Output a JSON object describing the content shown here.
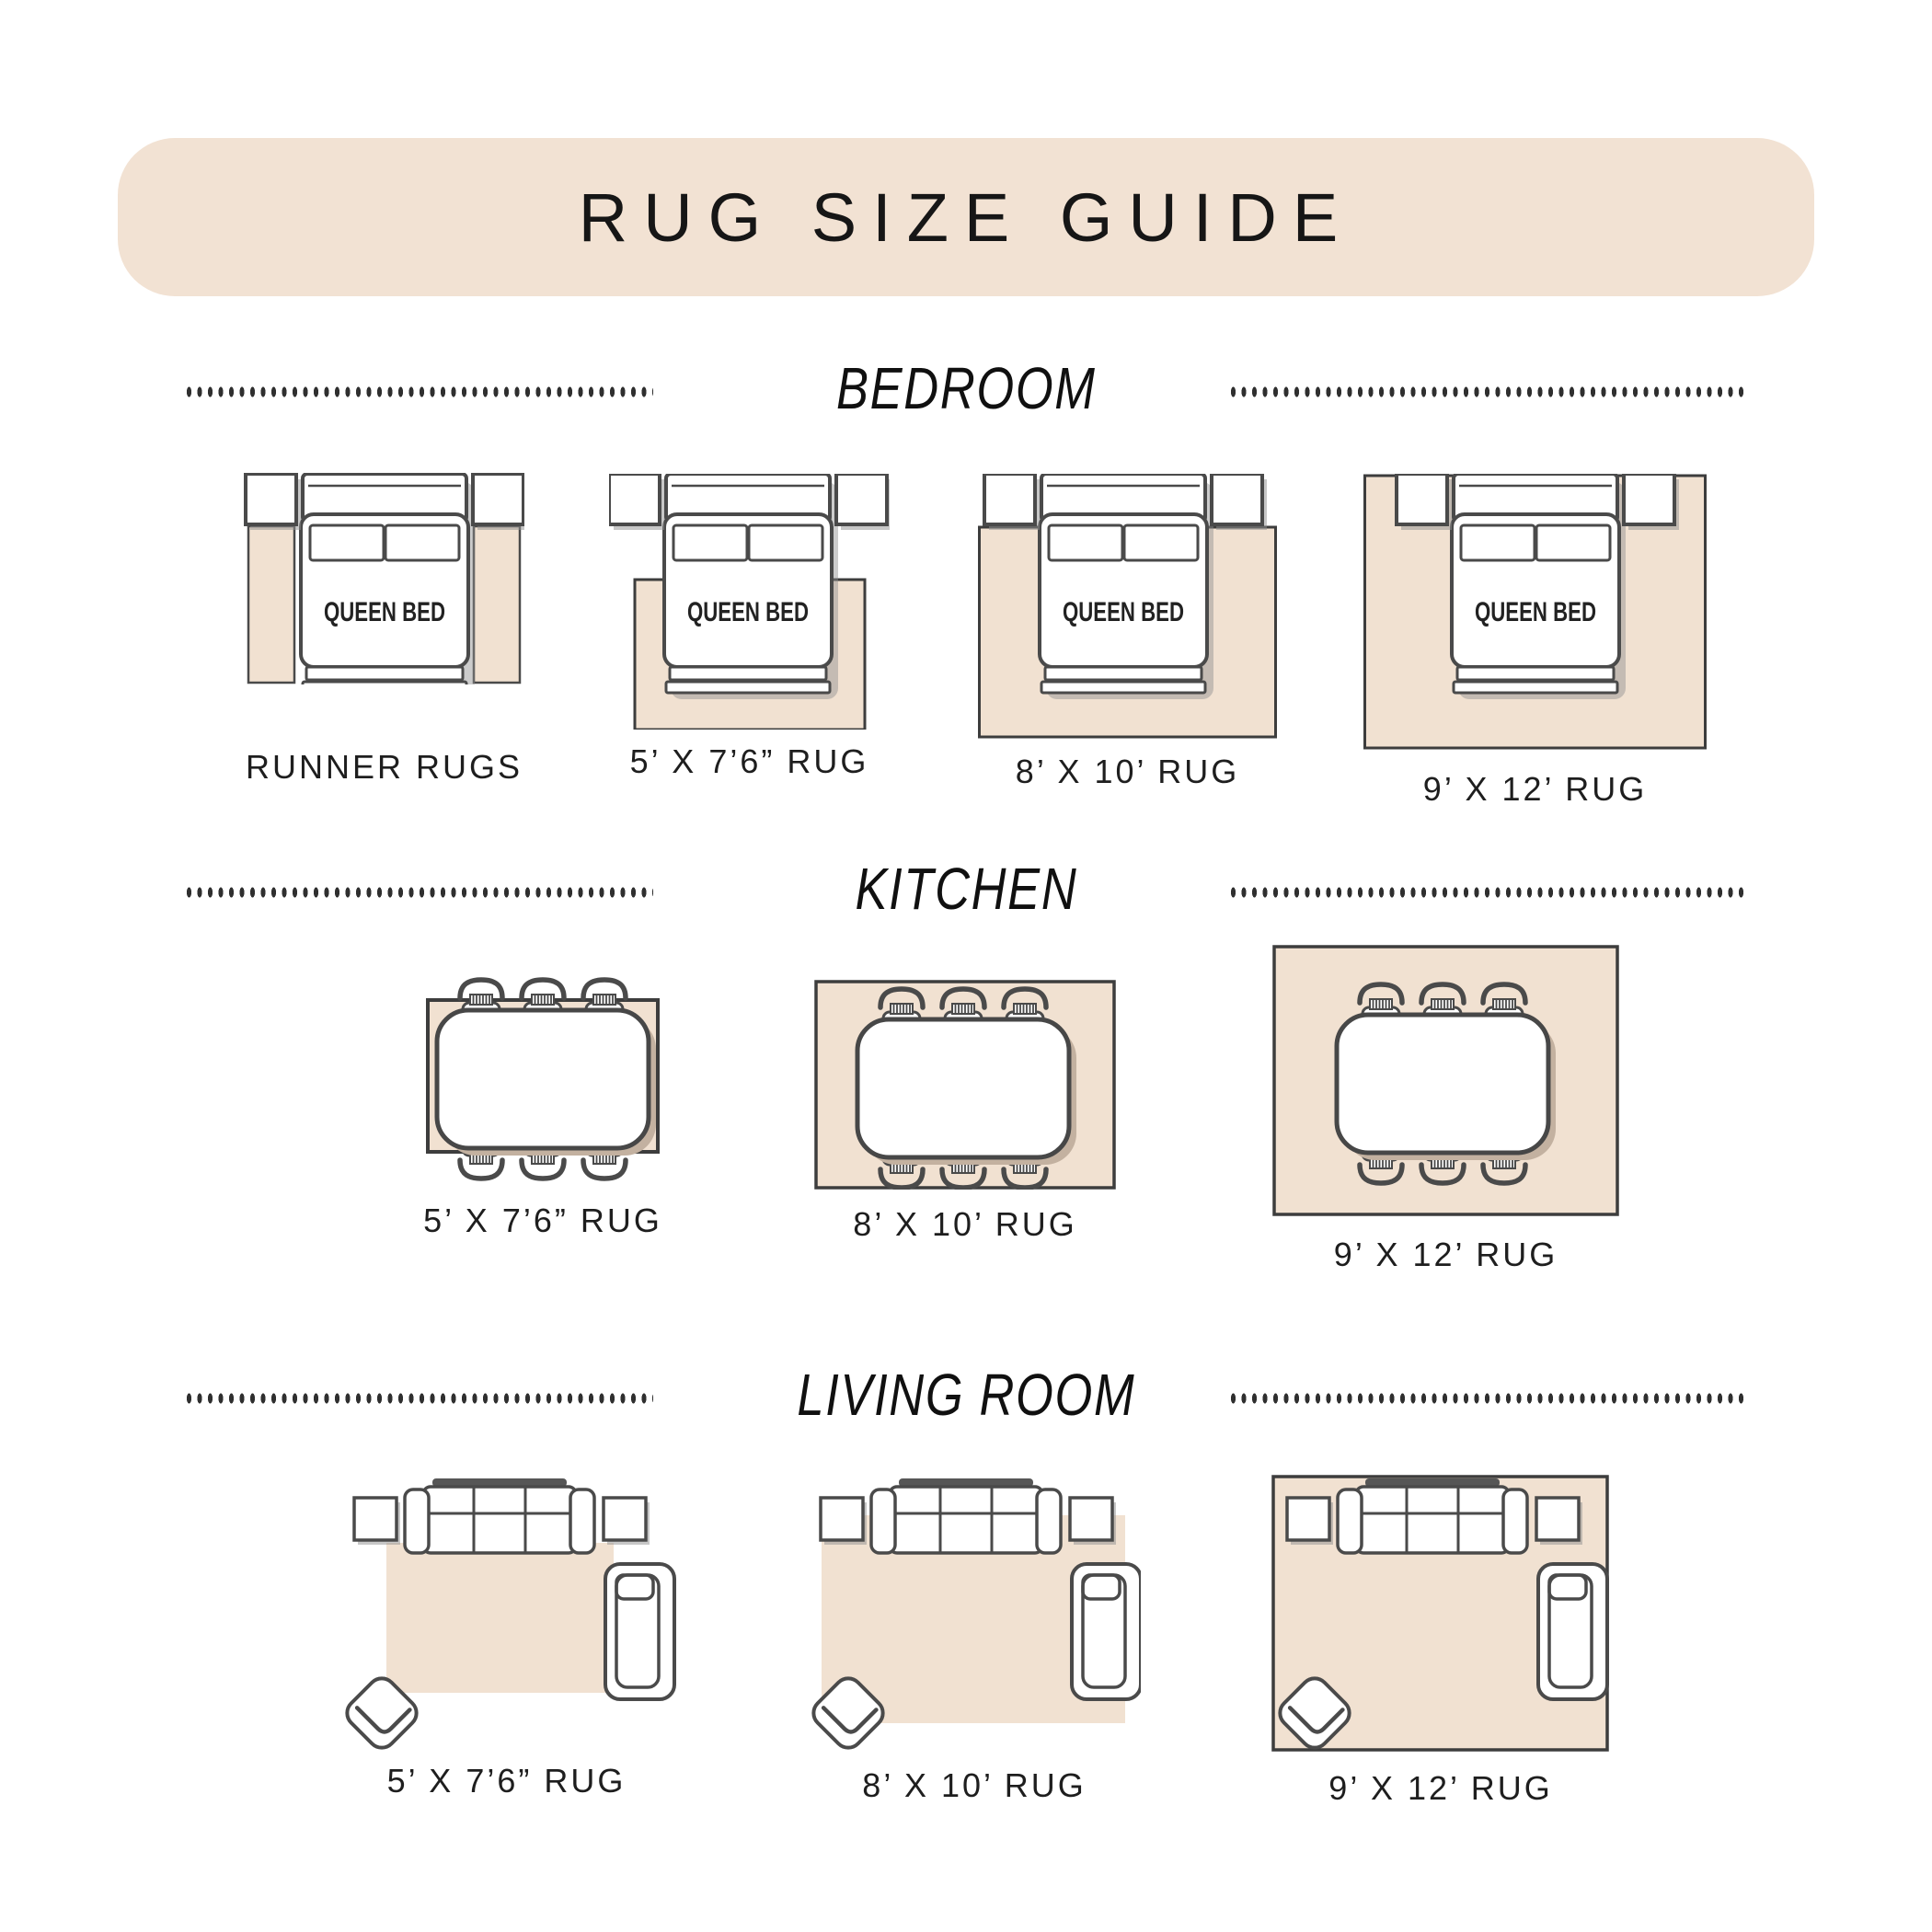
{
  "title": "RUG SIZE GUIDE",
  "bed_label": "QUEEN BED",
  "sections": [
    {
      "title": "BEDROOM",
      "items": [
        {
          "label": "RUNNER RUGS"
        },
        {
          "label": "5’ X 7’6” RUG"
        },
        {
          "label": "8’ X 10’ RUG"
        },
        {
          "label": "9’ X 12’ RUG"
        }
      ]
    },
    {
      "title": "KITCHEN",
      "items": [
        {
          "label": "5’ X 7’6” RUG"
        },
        {
          "label": "8’ X 10’ RUG"
        },
        {
          "label": "9’ X 12’ RUG"
        }
      ]
    },
    {
      "title": "LIVING ROOM",
      "items": [
        {
          "label": "5’ X 7’6” RUG"
        },
        {
          "label": "8’ X 10’ RUG"
        },
        {
          "label": "9’ X 12’ RUG"
        }
      ]
    }
  ],
  "colors": {
    "banner": "#f2e2d3",
    "rug": "#f1e1d1",
    "outline": "#4a4a4a",
    "rug_border": "#3d3d3d",
    "shadow": "#8f8f8f",
    "table_shadow": "#c3b1a0",
    "text": "#1e1e1e"
  }
}
